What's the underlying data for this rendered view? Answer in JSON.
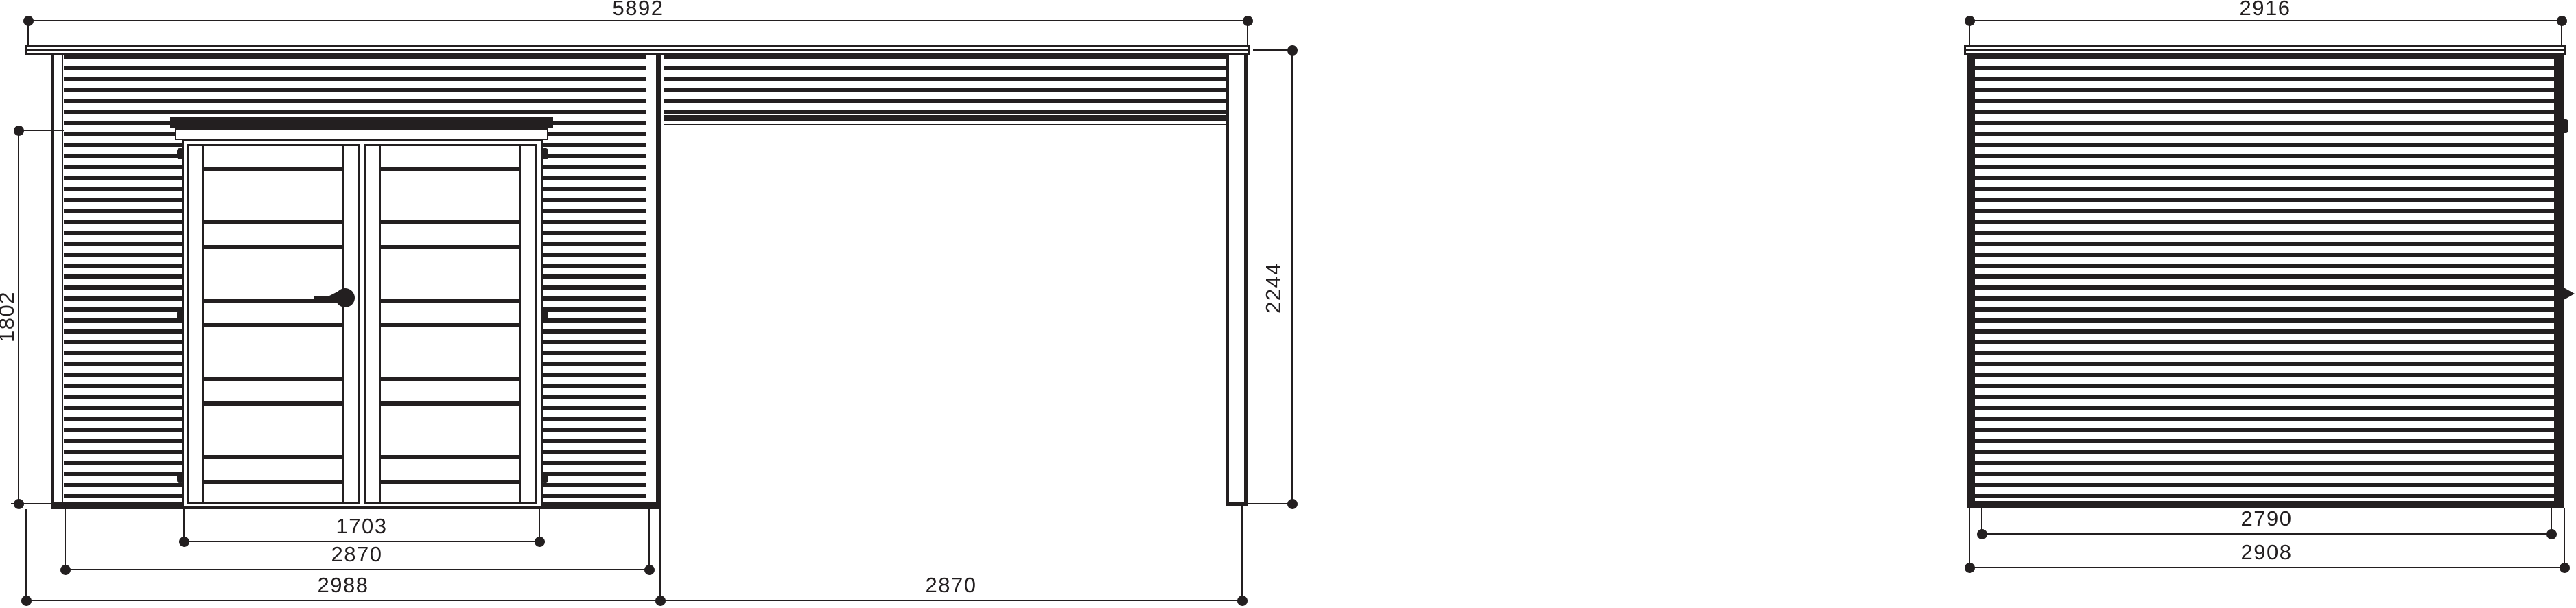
{
  "document": {
    "type": "technical-elevation-drawing",
    "subject": "flat-roof garden shed with side canopy",
    "ink_color": "#231f20",
    "paper_color": "#ffffff"
  },
  "front_view": {
    "name": "front elevation with canopy",
    "dim_overall_width": "5892",
    "dim_door_opening_height": "1802",
    "dim_canopy_height": "2244",
    "dim_door_width": "1703",
    "dim_shed_wall_width": "2870",
    "dim_shed_base_width": "2988",
    "dim_canopy_width": "2870"
  },
  "side_view": {
    "name": "side elevation",
    "dim_overall_depth": "2916",
    "dim_wall_depth": "2790",
    "dim_base_depth": "2908"
  }
}
